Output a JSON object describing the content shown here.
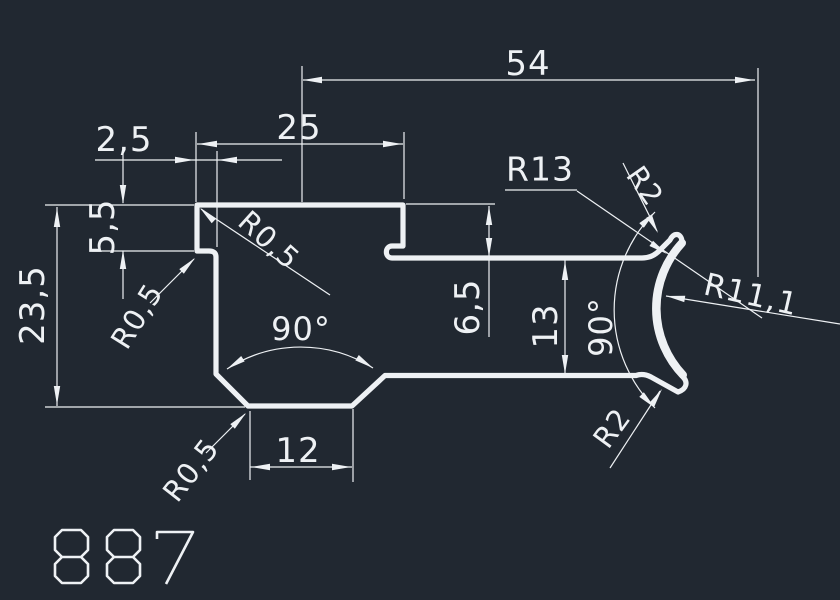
{
  "canvas": {
    "width": 840,
    "height": 600,
    "bg": "#212831",
    "ink": "#eef1f4"
  },
  "drawing_number": {
    "value": "887"
  },
  "profile": {
    "outline_d": "M 197 205 L 403 205 L 403 246 L 392 246 C 384.5 246 384.5 258 392 258 L 642 258 Q 652 258 659 251 L 670 240 C 674 232 681 233 682 241 A 97 97 0 0 0 683 377 C 688 382 687 389 678 392 L 651 377 Q 643 373 636 375.5 L 385 375.5 L 352 406 L 248 406 L 216 374 L 216 257 Q 216 251 209 251 L 197 251 Z",
    "arc_overlay_d": "M 682 243 A 97 97 0 0 0 683 375",
    "stroke_width": 5.2,
    "arc_stroke_width": 8
  },
  "thin": {
    "stroke_width": 1.2
  },
  "lines": [
    {
      "n": "dim-54-line",
      "p": [
        303,
        80,
        755,
        80
      ]
    },
    {
      "n": "ext-line-54-left",
      "p": [
        302,
        66,
        302,
        202
      ]
    },
    {
      "n": "ext-line-54-right",
      "p": [
        758,
        68,
        758,
        277
      ]
    },
    {
      "n": "dim-25-line",
      "p": [
        197,
        144,
        403,
        144
      ]
    },
    {
      "n": "ext-line-25-left",
      "p": [
        196,
        132,
        196,
        202
      ]
    },
    {
      "n": "ext-line-25-right",
      "p": [
        404,
        132,
        404,
        199
      ]
    },
    {
      "n": "dim-2-5-line",
      "p": [
        95,
        160,
        282,
        160
      ]
    },
    {
      "n": "ext-line-2-5-right",
      "p": [
        217,
        151,
        217,
        247
      ]
    },
    {
      "n": "dim-5-5-tail-top",
      "p": [
        123,
        149,
        123,
        203
      ]
    },
    {
      "n": "dim-5-5-tail-bottom",
      "p": [
        123,
        251,
        123,
        299
      ]
    },
    {
      "n": "ext-line-top-left",
      "p": [
        45,
        205,
        194,
        205
      ]
    },
    {
      "n": "ext-line-5-5-bottom",
      "p": [
        92,
        251,
        194,
        251
      ]
    },
    {
      "n": "dim-23-5-line",
      "p": [
        57,
        207,
        57,
        406
      ]
    },
    {
      "n": "ext-line-23-5-bottom",
      "p": [
        45,
        407,
        245,
        407
      ]
    },
    {
      "n": "dim-6-5-line",
      "p": [
        489,
        206,
        489,
        337
      ]
    },
    {
      "n": "ext-line-6-5-top",
      "p": [
        406,
        204,
        495,
        204
      ]
    },
    {
      "n": "dim-13-line",
      "p": [
        565,
        260,
        565,
        374
      ]
    },
    {
      "n": "dim-12-line",
      "p": [
        250,
        467,
        352,
        467
      ]
    },
    {
      "n": "ext-line-12-left",
      "p": [
        250,
        411,
        250,
        480
      ]
    },
    {
      "n": "ext-line-12-right",
      "p": [
        353,
        409,
        353,
        482
      ]
    },
    {
      "n": "leader-r13",
      "p": [
        577,
        191,
        762,
        318
      ]
    },
    {
      "n": "r13-underline",
      "p": [
        505,
        190,
        577,
        190
      ]
    },
    {
      "n": "leader-r2-top",
      "p": [
        623,
        163,
        657,
        231
      ]
    },
    {
      "n": "leader-r2-bottom",
      "p": [
        610,
        468,
        660,
        391
      ]
    },
    {
      "n": "leader-r11-1",
      "p": [
        666,
        296,
        840,
        324
      ]
    },
    {
      "n": "leader-r0-5-top",
      "p": [
        201,
        209,
        330,
        295
      ]
    },
    {
      "n": "leader-r0-5-left",
      "p": [
        194,
        259,
        150,
        303
      ]
    },
    {
      "n": "leader-r0-5-bottom",
      "p": [
        245,
        414,
        206,
        453
      ]
    }
  ],
  "arcs": [
    {
      "n": "angle-90-bottom-arc",
      "d": "M 227 369 A 135 135 0 0 1 373 368"
    },
    {
      "n": "angle-90-right-arc",
      "d": "M 655 212 A 138 138 0 0 0 655 408"
    }
  ],
  "arrows": [
    {
      "x": 303,
      "y": 80,
      "r": 180
    },
    {
      "x": 754,
      "y": 80,
      "r": 0
    },
    {
      "x": 198,
      "y": 144,
      "r": 180
    },
    {
      "x": 402,
      "y": 144,
      "r": 0
    },
    {
      "x": 194,
      "y": 160,
      "r": 0
    },
    {
      "x": 218,
      "y": 160,
      "r": 180
    },
    {
      "x": 123,
      "y": 204,
      "r": 90
    },
    {
      "x": 123,
      "y": 250,
      "r": 270
    },
    {
      "x": 57,
      "y": 208,
      "r": 270
    },
    {
      "x": 57,
      "y": 405,
      "r": 90
    },
    {
      "x": 489,
      "y": 206,
      "r": 270
    },
    {
      "x": 489,
      "y": 257,
      "r": 90
    },
    {
      "x": 565,
      "y": 261,
      "r": 270
    },
    {
      "x": 565,
      "y": 374,
      "r": 90
    },
    {
      "x": 251,
      "y": 467,
      "r": 180
    },
    {
      "x": 351,
      "y": 467,
      "r": 0
    },
    {
      "x": 227,
      "y": 369,
      "r": 147
    },
    {
      "x": 373,
      "y": 368,
      "r": 33
    },
    {
      "x": 655,
      "y": 212,
      "r": -45
    },
    {
      "x": 655,
      "y": 408,
      "r": 45
    },
    {
      "x": 667,
      "y": 254,
      "r": 34
    },
    {
      "x": 658,
      "y": 233,
      "r": 62
    },
    {
      "x": 662,
      "y": 389,
      "r": 303
    },
    {
      "x": 666,
      "y": 296,
      "r": 189
    },
    {
      "x": 200,
      "y": 208,
      "r": 223
    },
    {
      "x": 195,
      "y": 258,
      "r": -45
    },
    {
      "x": 246,
      "y": 413,
      "r": -45
    }
  ],
  "labels": [
    {
      "n": "dim-54-label",
      "t": "54",
      "x": 528,
      "y": 64,
      "r": 0,
      "s": 34
    },
    {
      "n": "dim-25-label",
      "t": "25",
      "x": 299,
      "y": 128,
      "r": 0,
      "s": 34
    },
    {
      "n": "dim-2-5-label",
      "t": "2,5",
      "x": 124,
      "y": 140,
      "r": 0,
      "s": 34
    },
    {
      "n": "dim-5-5-label",
      "t": "5,5",
      "x": 103,
      "y": 227,
      "r": -90,
      "s": 34
    },
    {
      "n": "dim-23-5-label",
      "t": "23,5",
      "x": 33,
      "y": 305,
      "r": -90,
      "s": 34
    },
    {
      "n": "dim-6-5-label",
      "t": "6,5",
      "x": 468,
      "y": 307,
      "r": -90,
      "s": 34
    },
    {
      "n": "dim-13-label",
      "t": "13",
      "x": 546,
      "y": 326,
      "r": -90,
      "s": 34
    },
    {
      "n": "angle-90-right-label",
      "t": "90°",
      "x": 601,
      "y": 327,
      "r": -90,
      "s": 32
    },
    {
      "n": "angle-90-bottom-label",
      "t": "90°",
      "x": 301,
      "y": 329,
      "r": 0,
      "s": 32
    },
    {
      "n": "dim-12-label",
      "t": "12",
      "x": 298,
      "y": 451,
      "r": 0,
      "s": 34
    },
    {
      "n": "radius-r13-label",
      "t": "R13",
      "x": 540,
      "y": 169,
      "r": 0,
      "s": 33
    },
    {
      "n": "radius-r11-1-label",
      "t": "R11,1",
      "x": 751,
      "y": 295,
      "r": 13,
      "s": 31
    },
    {
      "n": "radius-r2-top-label",
      "t": "R2",
      "x": 645,
      "y": 186,
      "r": 55,
      "s": 29
    },
    {
      "n": "radius-r2-bottom-label",
      "t": "R2",
      "x": 612,
      "y": 428,
      "r": -54,
      "s": 29
    },
    {
      "n": "radius-r0-5-top-label",
      "t": "R0,5",
      "x": 269,
      "y": 240,
      "r": 42,
      "s": 29
    },
    {
      "n": "radius-r0-5-left-label",
      "t": "R0,5",
      "x": 137,
      "y": 316,
      "r": -58,
      "s": 29
    },
    {
      "n": "radius-r0-5-bottom-label",
      "t": "R0,5",
      "x": 191,
      "y": 470,
      "r": -52,
      "s": 29
    }
  ],
  "stencil_digits": {
    "stroke_width": 2.6,
    "glyphs": [
      {
        "n": "digit-8-first",
        "d": "M 62 530 L 81 530 L 88 537 L 88 550 L 81 557 L 62 557 L 55 550 L 55 537 Z M 62 557 L 81 557 L 88 564 L 88 576 L 81 583 L 62 583 L 55 576 L 55 564 Z"
      },
      {
        "n": "digit-8-second",
        "d": "M 114 530 L 133 530 L 140 537 L 140 550 L 133 557 L 114 557 L 107 550 L 107 537 Z M 114 557 L 133 557 L 140 564 L 140 576 L 133 583 L 114 583 L 107 576 L 107 564 Z"
      },
      {
        "n": "digit-7",
        "d": "M 157 539 L 157 532 L 193 532 L 166 584"
      }
    ]
  }
}
